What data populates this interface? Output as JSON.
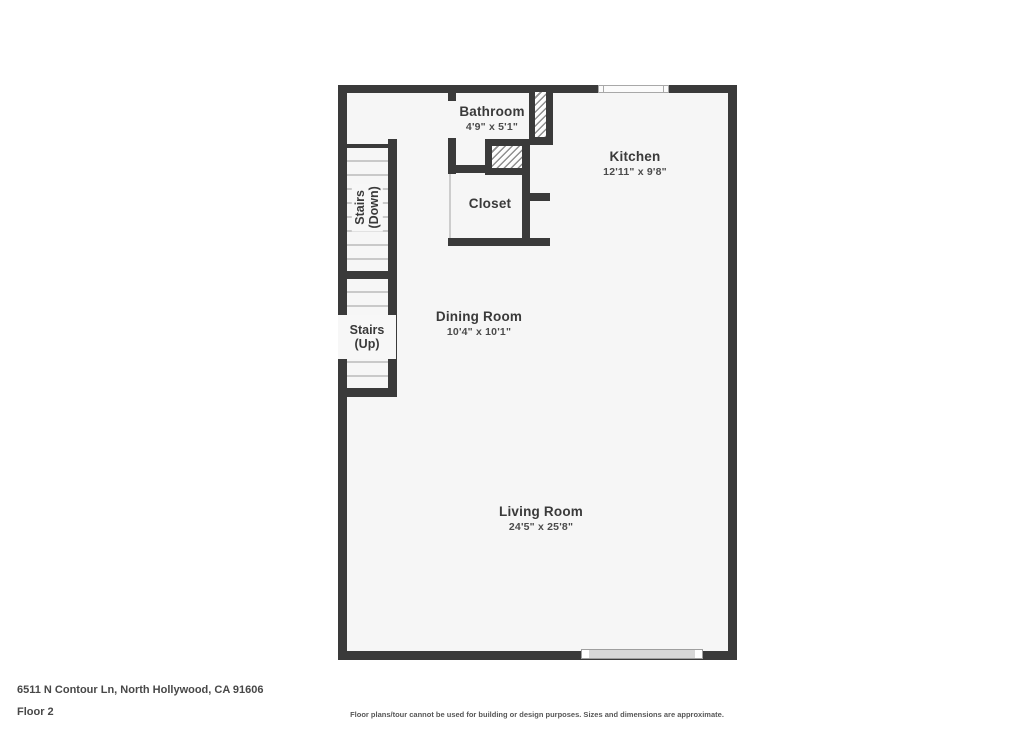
{
  "colors": {
    "wall": "#3a3a3a",
    "floor_fill": "#f6f6f6",
    "page_background": "#ffffff",
    "stair_tread_line": "#c9c9c9",
    "hatch_line": "#8f8f8f",
    "window_fill": "#d7d7d7",
    "label_text": "#3a3a3a"
  },
  "floorplan": {
    "rooms": [
      {
        "name": "Bathroom",
        "dims": "4'9\" x 5'1\""
      },
      {
        "name": "Kitchen",
        "dims": "12'11\" x 9'8\""
      },
      {
        "name": "Closet"
      },
      {
        "name": "Dining Room",
        "dims": "10'4\" x 10'1\""
      },
      {
        "name": "Living Room",
        "dims": "24'5\" x 25'8\""
      }
    ],
    "stairs_down": {
      "line1": "Stairs",
      "line2": "(Down)"
    },
    "stairs_up": {
      "line1": "Stairs",
      "line2": "(Up)"
    }
  },
  "footer": {
    "address": "6511 N Contour Ln, North Hollywood, CA 91606",
    "floor_label": "Floor 2",
    "disclaimer": "Floor plans/tour cannot be used for building or design purposes. Sizes and dimensions are approximate."
  }
}
